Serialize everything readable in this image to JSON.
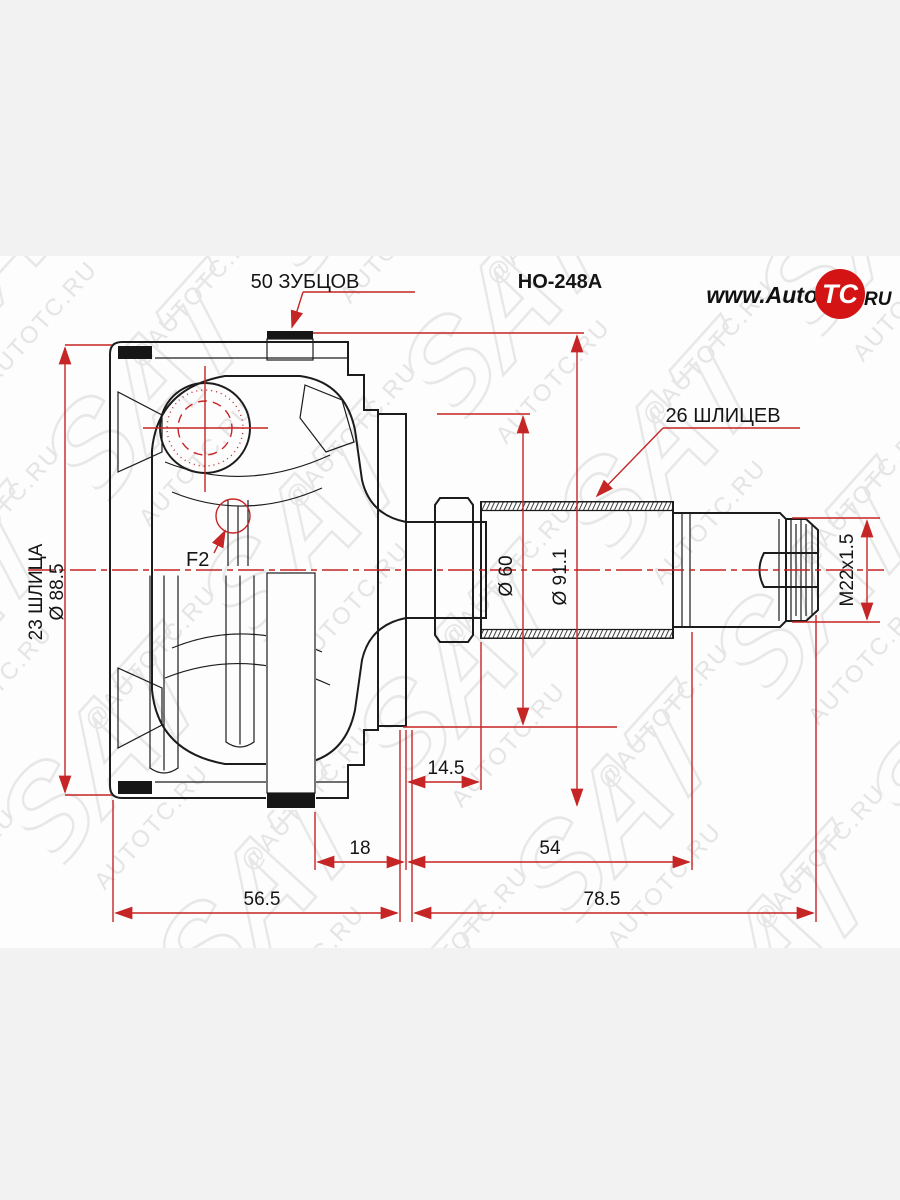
{
  "page": {
    "background": "#f2f2f2",
    "canvas_background": "#fdfdfd",
    "dimension_line_color": "#c62525",
    "drawing_line_color": "#1c1c1c"
  },
  "header": {
    "part_number": "HO-248A",
    "outer_teeth_label": "50 ЗУБЦОВ"
  },
  "logo": {
    "prefix": "www.Auto",
    "badge": "TC",
    "suffix": "RU",
    "badge_color": "#d41414"
  },
  "callouts": {
    "shaft_splines": "26 ШЛИЦЕВ",
    "inner_splines": "23 ШЛИЦА",
    "snap_ring": "F2"
  },
  "dimensions": {
    "housing_diameter": "Ø 88.5",
    "boot_seat_diameter": "Ø 60",
    "ring_diameter": "Ø 91.1",
    "thread": "M22x1.5",
    "boot_groove_width": "14.5",
    "ring_offset": "18",
    "spline_section_length": "54",
    "housing_length": "56.5",
    "shaft_length": "78.5"
  },
  "watermark": {
    "text_row1": "AUTOTC.RU",
    "text_row2": "@AUTOTC.RU",
    "logo_text": "SAT"
  }
}
